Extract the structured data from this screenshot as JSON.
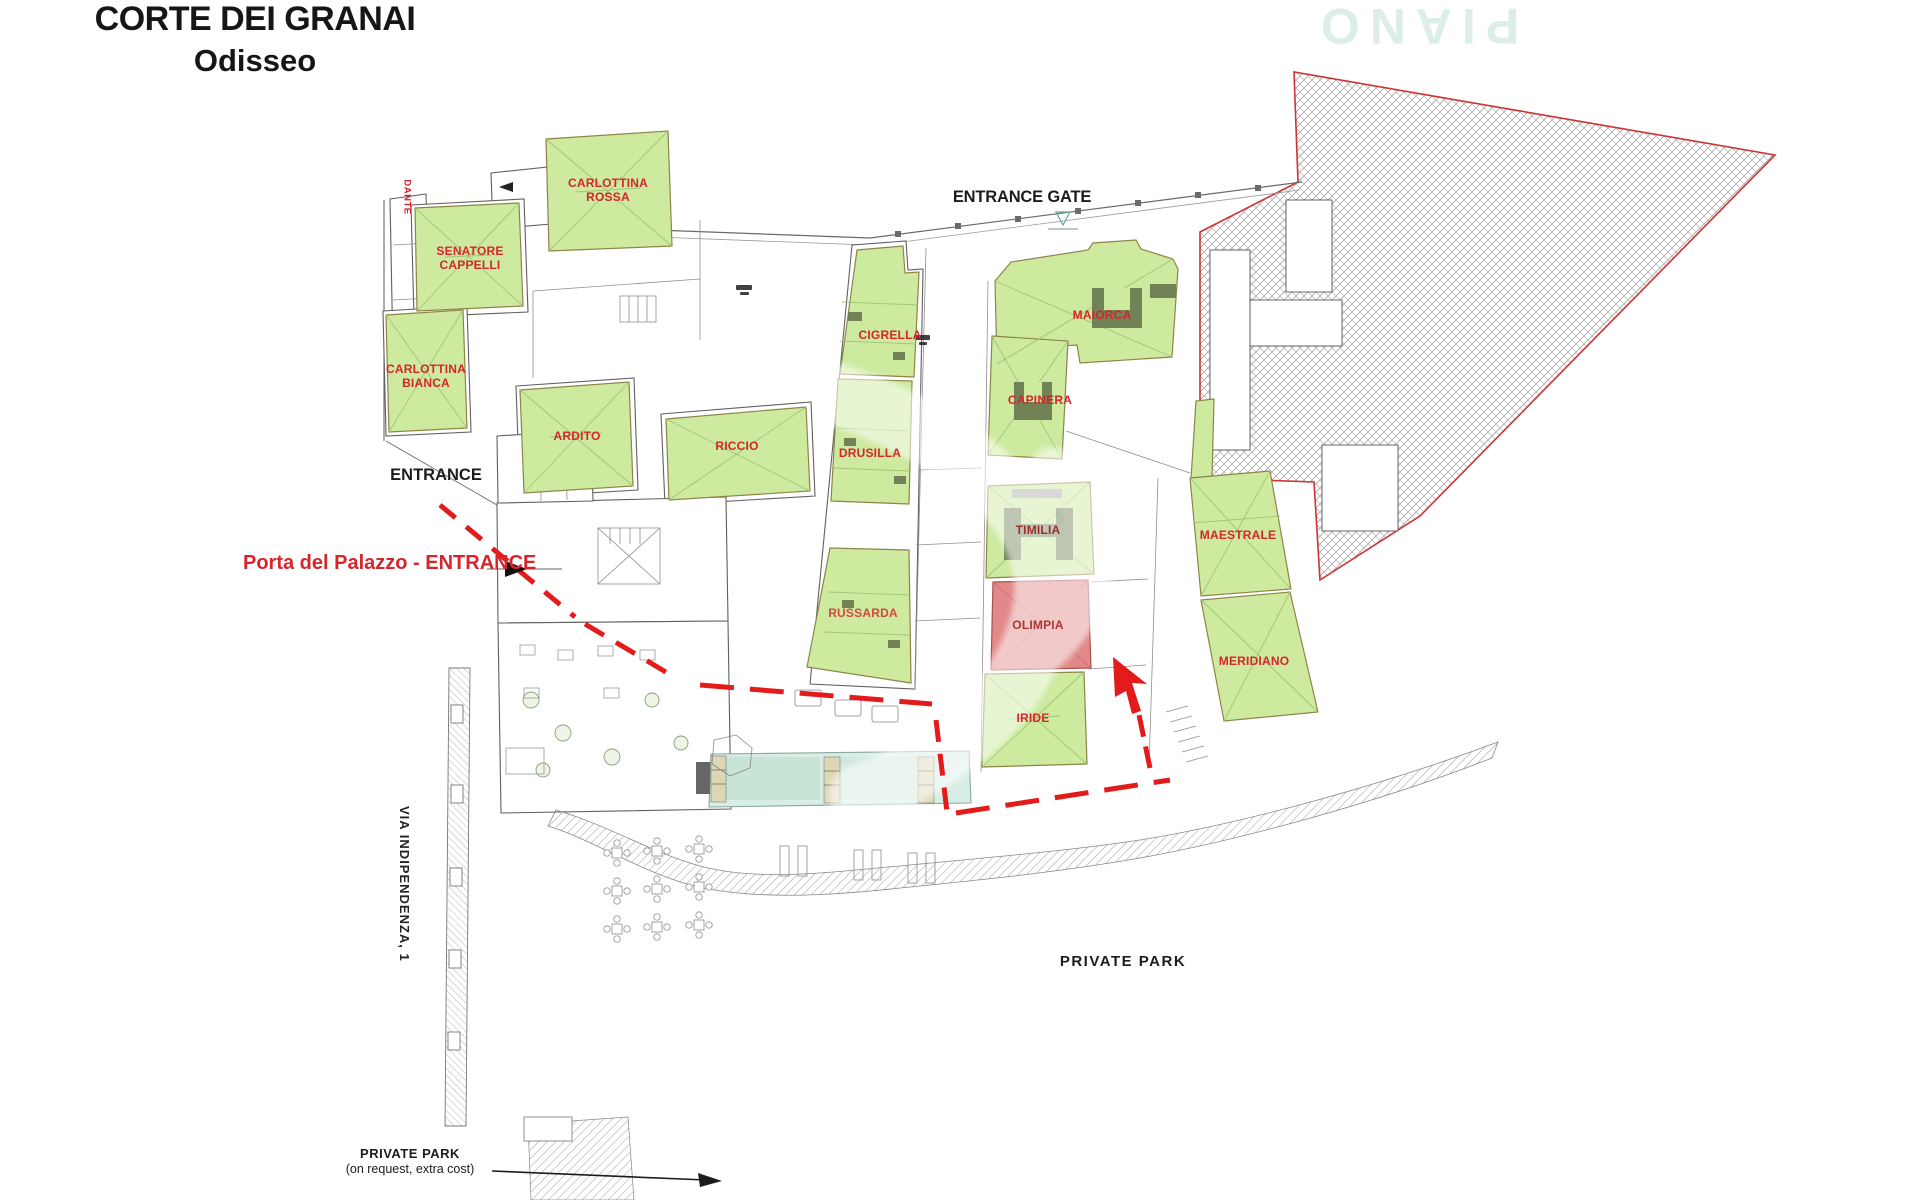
{
  "title": {
    "line1": "CORTE DEI GRANAI",
    "line2": "Odisseo"
  },
  "watermark_text": "PIANO TERRA",
  "annotations": {
    "entrance_gate": "ENTRANCE GATE",
    "entrance": "ENTRANCE",
    "palazzo_entrance": "Porta del Palazzo - ENTRANCE",
    "street": "VIA INDIPENDENZA, 1",
    "private_park": "PRIVATE PARK",
    "private_park_note_title": "PRIVATE PARK",
    "private_park_note_sub": "(on request, extra cost)"
  },
  "units": [
    {
      "name": "DANTE",
      "fill": "#ffffff"
    },
    {
      "name": "CARLOTTINA ROSSA",
      "fill": "#cdea9f"
    },
    {
      "name": "SENATORE CAPPELLI",
      "fill": "#cdea9f"
    },
    {
      "name": "CARLOTTINA BIANCA",
      "fill": "#cdea9f"
    },
    {
      "name": "ARDITO",
      "fill": "#cdea9f"
    },
    {
      "name": "RICCIO",
      "fill": "#cdea9f"
    },
    {
      "name": "CIGRELLA",
      "fill": "#cdea9f"
    },
    {
      "name": "DRUSILLA",
      "fill": "#cdea9f"
    },
    {
      "name": "RUSSARDA",
      "fill": "#cdea9f"
    },
    {
      "name": "MAIORCA",
      "fill": "#cdea9f"
    },
    {
      "name": "CAPINERA",
      "fill": "#cdea9f"
    },
    {
      "name": "TIMILIA",
      "fill": "#cdea9f"
    },
    {
      "name": "OLIMPIA",
      "fill": "#e28888"
    },
    {
      "name": "IRIDE",
      "fill": "#cdea9f"
    },
    {
      "name": "MAESTRALE",
      "fill": "#cdea9f"
    },
    {
      "name": "MERIDIANO",
      "fill": "#cdea9f"
    }
  ],
  "colors": {
    "label_red": "#d6252b",
    "unit_green": "#cdea9f",
    "highlight_red": "#e28888",
    "dashed_path_red": "#e31b1b",
    "boundary_red": "#cc3333",
    "pool_teal": "#d8ede4",
    "watermark_teal": "#dcedea"
  }
}
